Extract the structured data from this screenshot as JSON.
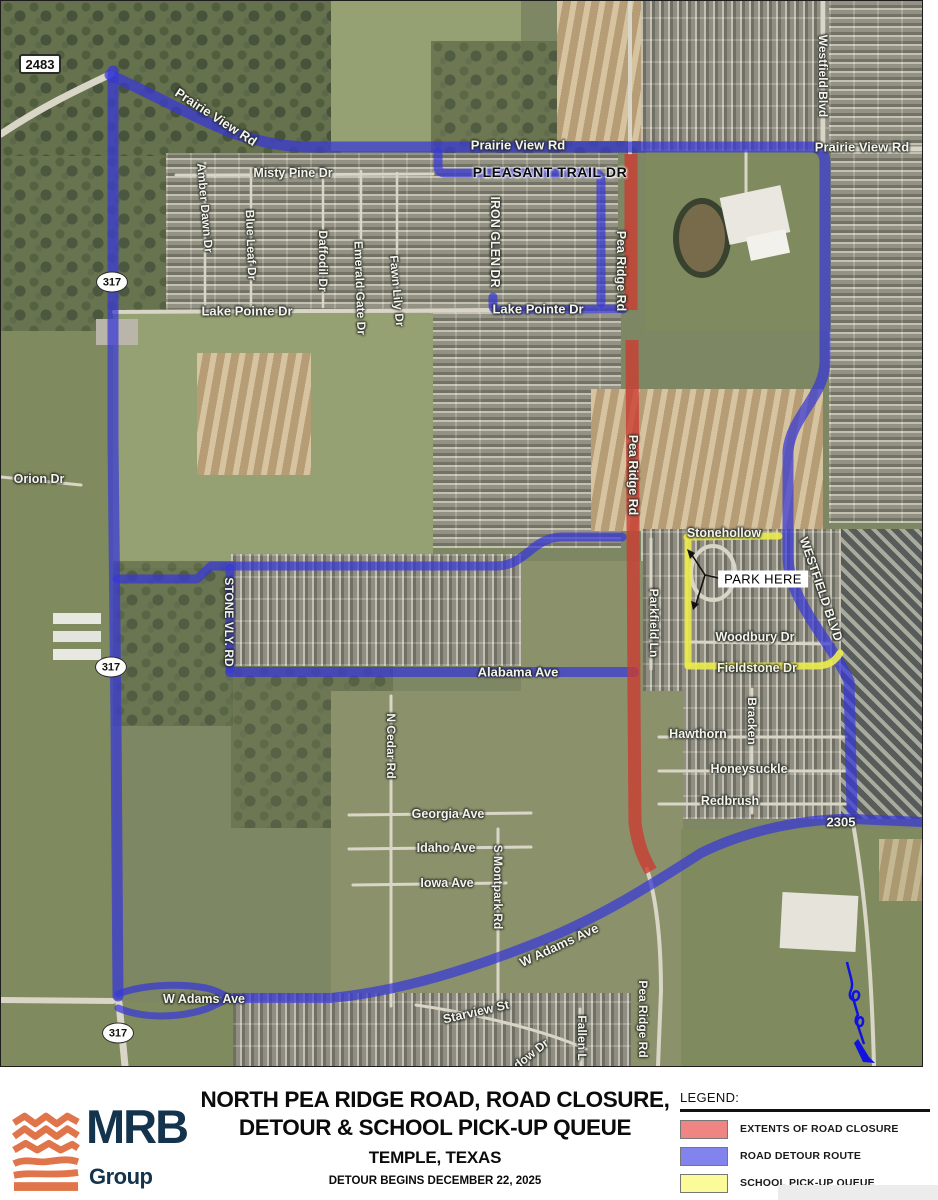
{
  "map": {
    "shields": [
      {
        "id": "fm-2483",
        "label": "2483",
        "shape": "rect",
        "x": 39,
        "y": 63
      },
      {
        "id": "sh-317-north",
        "label": "317",
        "shape": "oval",
        "x": 111,
        "y": 281
      },
      {
        "id": "sh-317-mid",
        "label": "317",
        "shape": "oval",
        "x": 110,
        "y": 666
      },
      {
        "id": "sh-317-south",
        "label": "317",
        "shape": "oval",
        "x": 117,
        "y": 1032
      }
    ],
    "labels": [
      {
        "id": "prairie-view-nw",
        "text": "Prairie View Rd",
        "x": 215,
        "y": 116,
        "rot": 33,
        "size": 13
      },
      {
        "id": "prairie-view-mid",
        "text": "Prairie View Rd",
        "x": 517,
        "y": 144,
        "rot": 0,
        "size": 13
      },
      {
        "id": "prairie-view-east",
        "text": "Prairie View Rd",
        "x": 861,
        "y": 146,
        "rot": 0,
        "size": 13
      },
      {
        "id": "misty-pine-dr",
        "text": "Misty Pine Dr",
        "x": 292,
        "y": 172,
        "rot": 0,
        "size": 12.5
      },
      {
        "id": "pleasant-trail-dr",
        "text": "PLEASANT TRAIL DR",
        "x": 549,
        "y": 171,
        "rot": 0,
        "size": 14,
        "color": "b"
      },
      {
        "id": "iron-glen-dr",
        "text": "IRON GLEN DR",
        "x": 494,
        "y": 241,
        "rot": 90,
        "size": 12.5
      },
      {
        "id": "amber-dawn-dr",
        "text": "Amber Dawn Dr",
        "x": 204,
        "y": 207,
        "rot": 85,
        "size": 12
      },
      {
        "id": "blue-leaf-dr",
        "text": "Blue Leaf Dr",
        "x": 250,
        "y": 244,
        "rot": 88,
        "size": 12
      },
      {
        "id": "daffodil-dr",
        "text": "Daffodil Dr",
        "x": 322,
        "y": 260,
        "rot": 90,
        "size": 12
      },
      {
        "id": "emerald-gate-dr",
        "text": "Emerald Gate Dr",
        "x": 359,
        "y": 287,
        "rot": 88,
        "size": 12
      },
      {
        "id": "fawn-lily-dr",
        "text": "Fawn Lily Dr",
        "x": 396,
        "y": 290,
        "rot": 85,
        "size": 12
      },
      {
        "id": "lake-pointe-dr-w",
        "text": "Lake Pointe Dr",
        "x": 246,
        "y": 310,
        "rot": 0,
        "size": 13
      },
      {
        "id": "lake-pointe-dr-e",
        "text": "Lake Pointe Dr",
        "x": 537,
        "y": 308,
        "rot": 0,
        "size": 13
      },
      {
        "id": "westfield-blvd-n",
        "text": "Westfield Blvd",
        "x": 822,
        "y": 75,
        "rot": 90,
        "size": 12
      },
      {
        "id": "pea-ridge-rd-n",
        "text": "Pea Ridge Rd",
        "x": 620,
        "y": 270,
        "rot": 90,
        "size": 12.5
      },
      {
        "id": "pea-ridge-rd-mid",
        "text": "Pea Ridge Rd",
        "x": 632,
        "y": 474,
        "rot": 90,
        "size": 12.5
      },
      {
        "id": "orion-dr",
        "text": "Orion Dr",
        "x": 38,
        "y": 478,
        "rot": 0,
        "size": 12.5
      },
      {
        "id": "stone-vly-rd",
        "text": "STONE VLY. RD",
        "x": 228,
        "y": 621,
        "rot": 90,
        "size": 12
      },
      {
        "id": "stonehollow",
        "text": "Stonehollow",
        "x": 723,
        "y": 532,
        "rot": 0,
        "size": 12.5
      },
      {
        "id": "westfield-blvd-s",
        "text": "WESTFIELD BLVD",
        "x": 820,
        "y": 588,
        "rot": 71,
        "size": 12.5
      },
      {
        "id": "parkfield-ln",
        "text": "Parkfield Ln",
        "x": 653,
        "y": 622,
        "rot": 90,
        "size": 12
      },
      {
        "id": "woodbury-dr",
        "text": "Woodbury Dr",
        "x": 754,
        "y": 636,
        "rot": 0,
        "size": 12.5
      },
      {
        "id": "fieldstone-dr",
        "text": "Fieldstone Dr",
        "x": 756,
        "y": 667,
        "rot": 0,
        "size": 12.5
      },
      {
        "id": "alabama-ave",
        "text": "Alabama Ave",
        "x": 517,
        "y": 671,
        "rot": 0,
        "size": 13
      },
      {
        "id": "bracken",
        "text": "Bracken",
        "x": 751,
        "y": 720,
        "rot": 90,
        "size": 12
      },
      {
        "id": "hawthorn",
        "text": "Hawthorn",
        "x": 697,
        "y": 733,
        "rot": 0,
        "size": 12.5
      },
      {
        "id": "honeysuckle",
        "text": "Honeysuckle",
        "x": 748,
        "y": 768,
        "rot": 0,
        "size": 12.5
      },
      {
        "id": "redbrush",
        "text": "Redbrush",
        "x": 729,
        "y": 800,
        "rot": 0,
        "size": 12.5
      },
      {
        "id": "n-cedar-rd",
        "text": "N Cedar Rd",
        "x": 390,
        "y": 745,
        "rot": 90,
        "size": 12
      },
      {
        "id": "georgia-ave",
        "text": "Georgia Ave",
        "x": 447,
        "y": 813,
        "rot": 0,
        "size": 12.5
      },
      {
        "id": "idaho-ave",
        "text": "Idaho Ave",
        "x": 445,
        "y": 847,
        "rot": 0,
        "size": 12.5
      },
      {
        "id": "iowa-ave",
        "text": "Iowa Ave",
        "x": 446,
        "y": 882,
        "rot": 0,
        "size": 12.5
      },
      {
        "id": "s-montpark-rd",
        "text": "S Montpark Rd",
        "x": 497,
        "y": 886,
        "rot": 90,
        "size": 12
      },
      {
        "id": "w-adams-ave-diag",
        "text": "W Adams Ave",
        "x": 558,
        "y": 944,
        "rot": -25,
        "size": 13
      },
      {
        "id": "fm-2305",
        "text": "2305",
        "x": 840,
        "y": 821,
        "rot": 0,
        "size": 13
      },
      {
        "id": "w-adams-ave-w",
        "text": "W Adams Ave",
        "x": 203,
        "y": 998,
        "rot": 0,
        "size": 12.5
      },
      {
        "id": "starview-st",
        "text": "Starview St",
        "x": 475,
        "y": 1011,
        "rot": -13,
        "size": 12.5
      },
      {
        "id": "meadow-dr",
        "text": "dow Dr",
        "x": 530,
        "y": 1053,
        "rot": -38,
        "size": 12
      },
      {
        "id": "fallen-ln",
        "text": "Fallen L",
        "x": 581,
        "y": 1037,
        "rot": 90,
        "size": 12
      },
      {
        "id": "pea-ridge-rd-s",
        "text": "Pea Ridge Rd",
        "x": 642,
        "y": 1018,
        "rot": 90,
        "size": 12
      }
    ],
    "callout": {
      "text": "PARK HERE"
    }
  },
  "route_colors": {
    "closure": "#cc3a30",
    "detour": "#3737d8",
    "queue": "#eaea4e"
  },
  "footer": {
    "logo": {
      "name": "MRB",
      "sub": "Group",
      "mark_color": "#e0744a",
      "text_color": "#14344e"
    },
    "title_line1": "NORTH PEA RIDGE ROAD, ROAD CLOSURE,",
    "title_line2": "DETOUR & SCHOOL PICK-UP QUEUE",
    "title_line3": "TEMPLE, TEXAS",
    "title_line4": "DETOUR BEGINS DECEMBER 22, 2025",
    "legend": {
      "title": "LEGEND:",
      "items": [
        {
          "label": "EXTENTS OF ROAD CLOSURE",
          "color": "#ef8583"
        },
        {
          "label": "ROAD DETOUR ROUTE",
          "color": "#8283ec"
        },
        {
          "label": "SCHOOL PICK-UP QUEUE",
          "color": "#fbfb9a"
        }
      ]
    }
  }
}
